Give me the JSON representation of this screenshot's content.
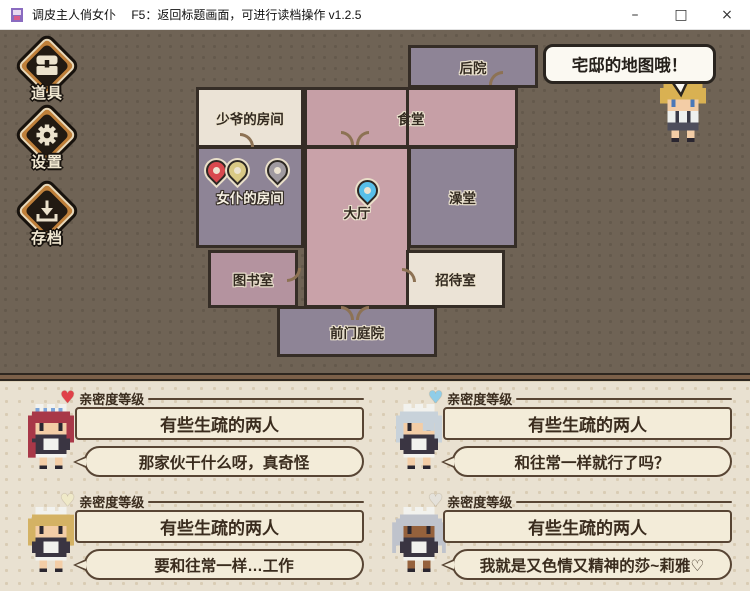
{
  "window": {
    "title": "调皮主人俏女仆　 F5：返回标题画面，可进行读档操作 v1.2.5",
    "controls": {
      "minimize": "–",
      "maximize": "□",
      "close": "×"
    }
  },
  "menu": {
    "items": [
      {
        "id": "items",
        "label": "道具",
        "icon": "chest-icon"
      },
      {
        "id": "settings",
        "label": "设置",
        "icon": "gear-icon"
      },
      {
        "id": "save",
        "label": "存档",
        "icon": "save-icon"
      }
    ]
  },
  "map": {
    "speech_bubble": "宅邸的地图哦！",
    "rooms": [
      {
        "id": "backyard",
        "label": "后院"
      },
      {
        "id": "master-room",
        "label": "少爷的房间"
      },
      {
        "id": "dining-hall",
        "label": "食堂"
      },
      {
        "id": "maid-room",
        "label": "女仆的房间",
        "highlighted": true
      },
      {
        "id": "main-hall",
        "label": "大厅"
      },
      {
        "id": "bathhouse",
        "label": "澡堂"
      },
      {
        "id": "library",
        "label": "图书室"
      },
      {
        "id": "reception-room",
        "label": "招待室"
      },
      {
        "id": "front-yard",
        "label": "前门庭院"
      }
    ],
    "pins": [
      {
        "room": "maid-room",
        "color": "#d8494e"
      },
      {
        "room": "maid-room",
        "color": "#d9c985"
      },
      {
        "room": "maid-room",
        "color": "#a09aa0"
      },
      {
        "room": "main-hall",
        "color": "#58bfe8"
      }
    ]
  },
  "panels": {
    "heading": "亲密度等级",
    "items": [
      {
        "character": "red-haired-maid",
        "heart_color": "#e04048",
        "level": "有些生疏的两人",
        "dialogue": "那家伙干什么呀，真奇怪"
      },
      {
        "character": "silver-haired-maid",
        "heart_color": "#90cde8",
        "level": "有些生疏的两人",
        "dialogue": "和往常一样就行了吗？"
      },
      {
        "character": "blonde-maid",
        "heart_color": "#efe9c8",
        "level": "有些生疏的两人",
        "dialogue": "要和往常一样…工作"
      },
      {
        "character": "dark-skinned-maid",
        "heart_color": "#e4e1da",
        "level": "有些生疏的两人",
        "dialogue": "我就是又色情又精神的莎~莉雅♡"
      }
    ]
  },
  "colors": {
    "background_brown": "#6f6355",
    "room_pink": "#c69fa6",
    "room_purple": "#8e8496",
    "room_cream": "#ebe3d6",
    "room_mauve": "#b4939f",
    "panel_cream": "#e9e1d1",
    "box_border": "#584534"
  }
}
